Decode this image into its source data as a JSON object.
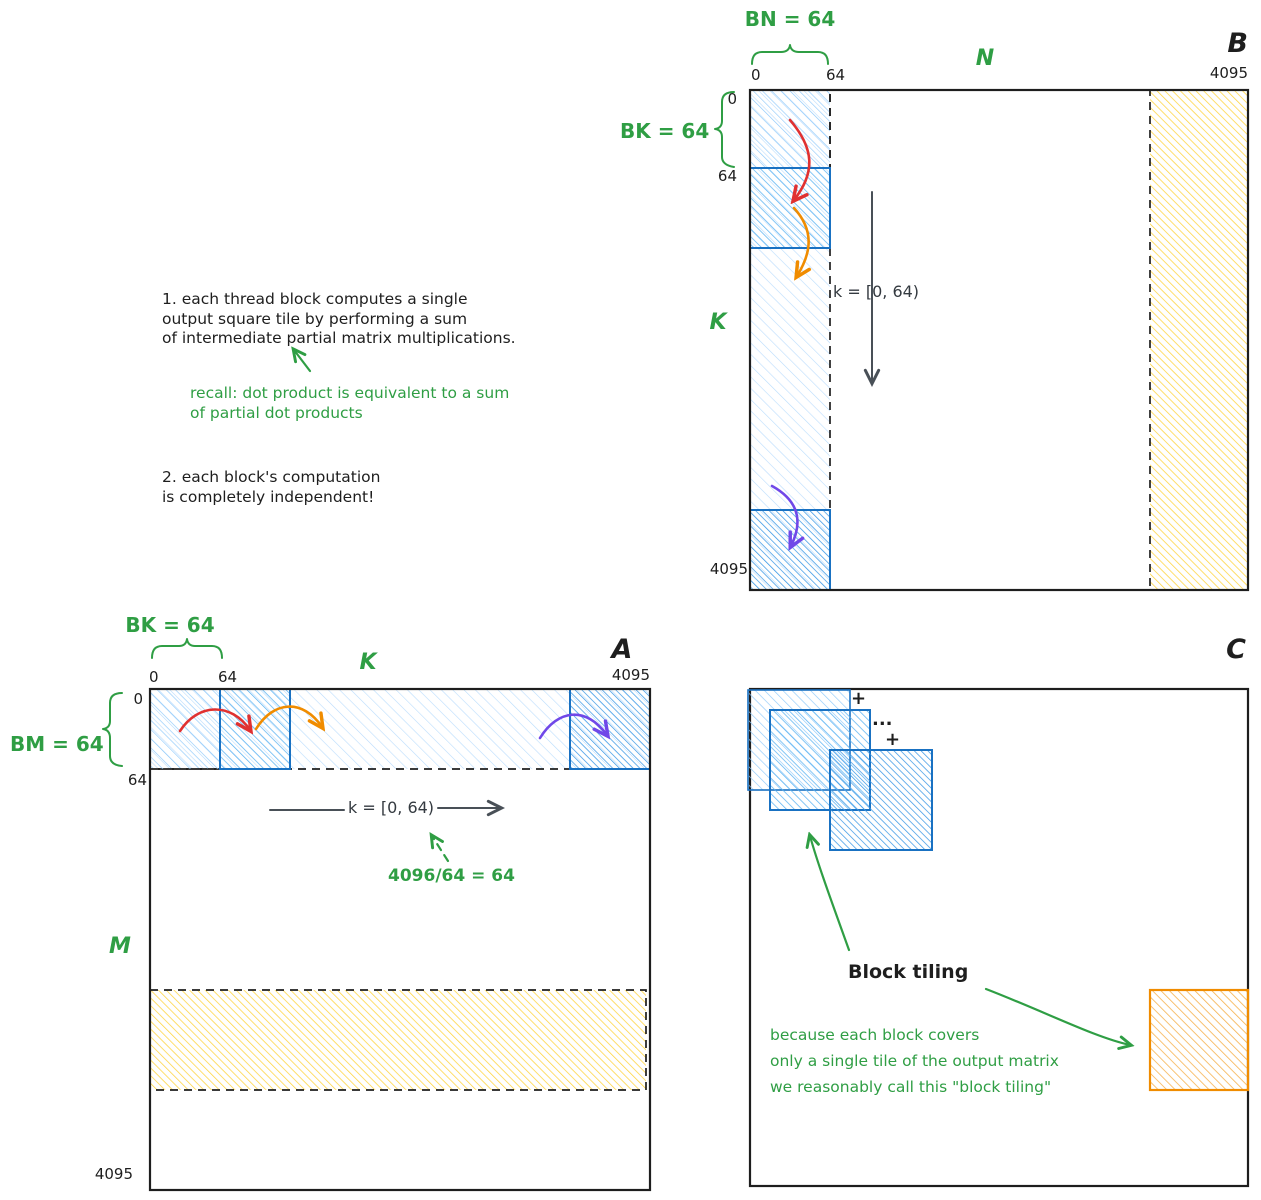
{
  "palette": {
    "ink": "#1e1e1e",
    "green": "#2f9e44",
    "red": "#e03131",
    "orange": "#f08c00",
    "purple": "#7048e8",
    "blue_border": "#1971c2",
    "blue_hatch": "#74c0fc",
    "yellow_hatch": "#ffd43b",
    "gray_arrow": "#495057"
  },
  "notes": {
    "item1": {
      "line1": "1. each thread block computes a single",
      "line2": "output square tile by performing a sum",
      "line3": "of intermediate partial matrix multiplications."
    },
    "recall": {
      "line1": "recall: dot product is equivalent to a sum",
      "line2": "of partial dot products"
    },
    "item2": {
      "line1": "2. each block's computation",
      "line2": "is completely independent!"
    }
  },
  "matrix_b": {
    "title": "B",
    "axis_top": "N",
    "axis_left": "K",
    "block_width_label": "BN = 64",
    "block_height_label": "BK = 64",
    "k_range": "k = [0, 64)",
    "ticks": {
      "top_0": "0",
      "top_64": "64",
      "top_4095": "4095",
      "left_0": "0",
      "left_64": "64",
      "left_4095": "4095"
    }
  },
  "matrix_a": {
    "title": "A",
    "axis_top": "K",
    "axis_left": "M",
    "block_width_label": "BK = 64",
    "block_height_label": "BM = 64",
    "k_range": "k = [0, 64)",
    "division_note": "4096/64 = 64",
    "ticks": {
      "top_0": "0",
      "top_64": "64",
      "top_4095": "4095",
      "left_0": "0",
      "left_64": "64",
      "left_4095": "4095"
    }
  },
  "matrix_c": {
    "title": "C",
    "plus_first": "+",
    "ellipsis": "...",
    "plus_second": "+",
    "heading": "Block tiling",
    "caption": {
      "line1": "because each block covers",
      "line2": "only a single tile of the output matrix",
      "line3": "we reasonably call this \"block tiling\""
    }
  }
}
